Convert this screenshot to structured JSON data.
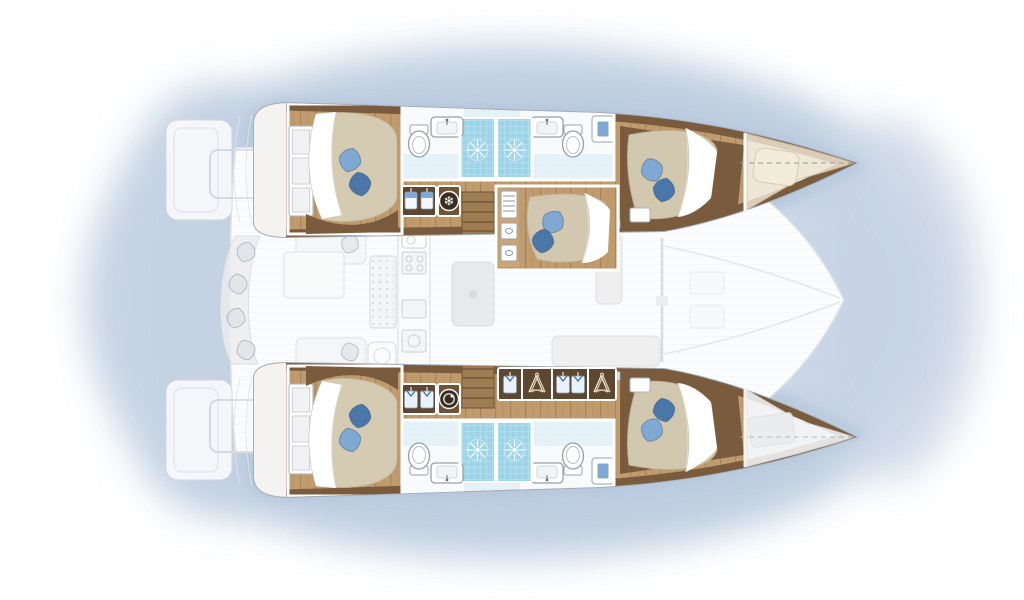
{
  "meta": {
    "title": "Catamaran yacht interior floor plan",
    "view": "top-down layout",
    "orientation": "bows pointing right",
    "vessel_type": "twin-hull sailing catamaran"
  },
  "counts": {
    "hulls": 2,
    "double_cabins": 5,
    "bathrooms": 4,
    "showers": 4,
    "forepeak_berths": 1
  },
  "hulls": {
    "port_top": {
      "rooms": [
        {
          "name": "aft double cabin",
          "features": [
            "double bed",
            "two blue pillows",
            "shelved wardrobe"
          ]
        },
        {
          "name": "aft bathroom",
          "fixtures": [
            "toilet",
            "washbasin",
            "tiled shower"
          ]
        },
        {
          "name": "forward bathroom",
          "fixtures": [
            "tiled shower",
            "washbasin",
            "toilet",
            "towel cabinet"
          ]
        },
        {
          "name": "linen locker with refrigerator"
        },
        {
          "name": "companionway steps"
        },
        {
          "name": "forward double cabin",
          "features": [
            "double bed",
            "two blue pillows"
          ]
        },
        {
          "name": "forepeak berth",
          "features": [
            "single cushion",
            "centerline"
          ]
        }
      ]
    },
    "starboard_bottom": {
      "rooms": [
        {
          "name": "aft double cabin",
          "features": [
            "double bed",
            "two blue pillows",
            "shelved wardrobe"
          ]
        },
        {
          "name": "aft bathroom",
          "fixtures": [
            "toilet",
            "washbasin",
            "tiled shower"
          ]
        },
        {
          "name": "forward bathroom",
          "fixtures": [
            "tiled shower",
            "washbasin",
            "toilet",
            "towel cabinet"
          ]
        },
        {
          "name": "laundry locker with washing machine"
        },
        {
          "name": "companionway steps"
        },
        {
          "name": "hanging wardrobes",
          "contents": [
            "shirt",
            "coat hangers",
            "two shirts",
            "coat hangers"
          ]
        },
        {
          "name": "forward double cabin",
          "features": [
            "double bed",
            "two blue pillows"
          ]
        },
        {
          "name": "forepeak storage (ghosted)"
        }
      ]
    }
  },
  "bridge_deck": {
    "rooms": [
      {
        "name": "aft cockpit",
        "features": [
          "curved bench with cushions",
          "cockpit tables",
          "swim transoms"
        ]
      },
      {
        "name": "saloon",
        "features": [
          "galley counter with sink and stove",
          "island unit",
          "dining table",
          "sofa"
        ]
      },
      {
        "name": "central double cabin",
        "features": [
          "double bed",
          "two blue pillows",
          "shelf ladder",
          "two drawers"
        ]
      },
      {
        "name": "foredeck"
      }
    ]
  },
  "icons": {
    "fridge": {
      "name": "snowflake-icon",
      "glyph": "❄",
      "meaning": "refrigerator / freezer"
    },
    "washing_machine": {
      "name": "washing-machine-icon",
      "meaning": "washing machine"
    },
    "shower_rose": {
      "name": "shower-rose-icon",
      "meaning": "shower head"
    },
    "hangers": {
      "name": "coat-hanger-icon",
      "meaning": "hanging wardrobe"
    },
    "towel": {
      "name": "towel-icon",
      "meaning": "linen locker"
    },
    "shirt": {
      "name": "shirt-icon",
      "meaning": "clothes locker"
    }
  },
  "palette": {
    "wood": "#c09b6e",
    "wood_line": "#a8855c",
    "wood_dark": "#7b5b3d",
    "locker_dark": "#5e4730",
    "mattress": "#d4c9b1",
    "sheet": "#ffffff",
    "pillow_light": "#7fa8d2",
    "pillow_dark": "#4a77a8",
    "shower_tile": "#9ed4e7",
    "bath_floor": "#e4f2f8",
    "ghost_fill": "#ededef",
    "ghost_stroke": "#d6dadd",
    "hull_outline": "#a3b0bb",
    "water_wash": "#c3d2e4"
  }
}
